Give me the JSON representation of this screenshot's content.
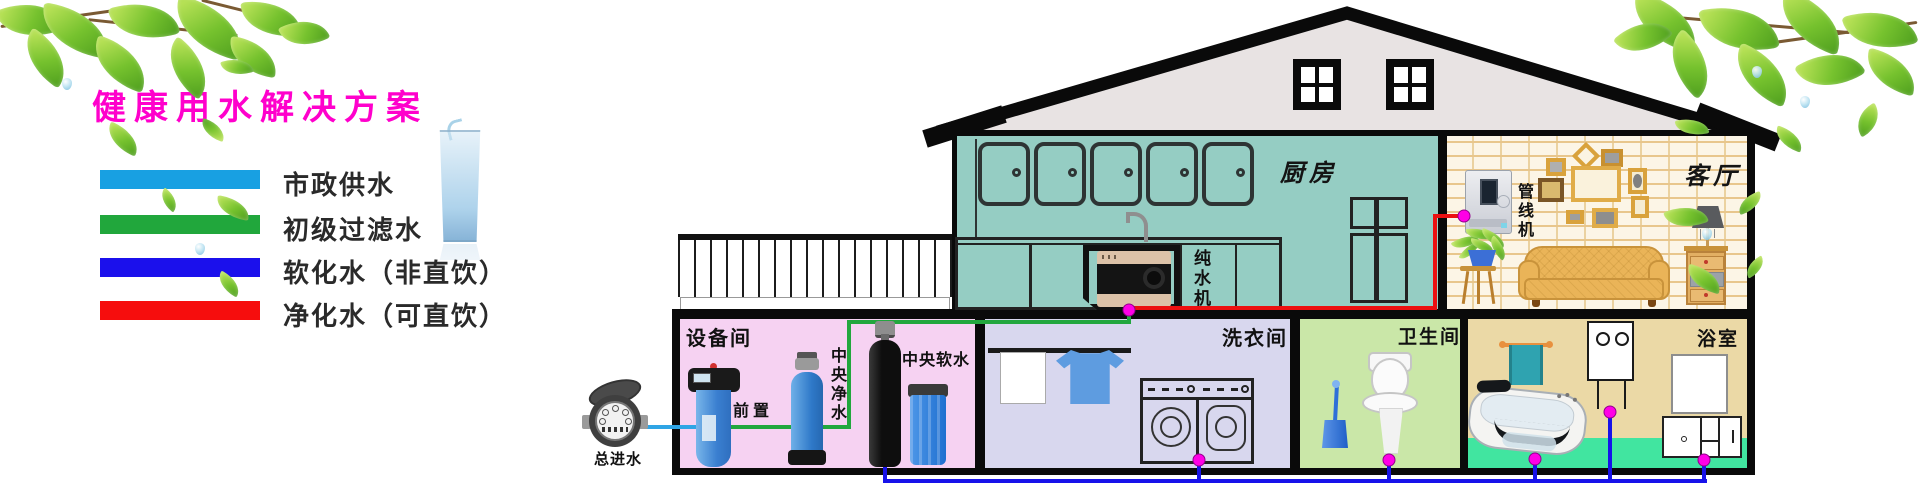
{
  "title": "健康用水解决方案",
  "title_color": "#FF00CC",
  "legend": {
    "items": [
      {
        "label": "市政供水",
        "color": "#18A0E2"
      },
      {
        "label": "初级过滤水",
        "color": "#21A73C"
      },
      {
        "label": "软化水（非直饮）",
        "color": "#1B10EC"
      },
      {
        "label": "净化水（可直饮）",
        "color": "#F60D0D"
      }
    ]
  },
  "rooms": {
    "kitchen": {
      "label": "厨房"
    },
    "living": {
      "label": "客厅"
    },
    "equipment": {
      "label": "设备间"
    },
    "laundry": {
      "label": "洗衣间"
    },
    "toilet": {
      "label": "卫生间"
    },
    "bath": {
      "label": "浴室"
    }
  },
  "equipment": {
    "prefilter": "前置",
    "central_purifier": "中央净水",
    "central_softener": "中央软水",
    "pure_water_machine": "纯水机",
    "pipeline_machine": "管线机",
    "main_inlet": "总进水"
  },
  "pipes": {
    "municipal": "#2FA5E5",
    "primary": "#22A73E",
    "softened": "#1712EA",
    "purified": "#EC1010",
    "joint_dot": "#FF00E6"
  }
}
